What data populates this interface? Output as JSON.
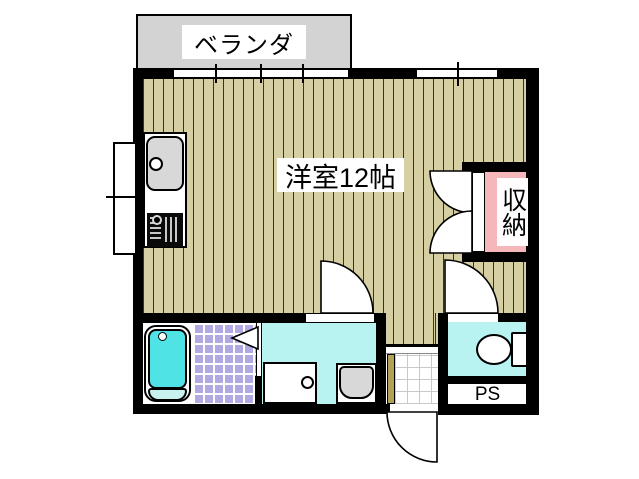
{
  "floorplan": {
    "labels": {
      "balcony": "ベランダ",
      "main_room": "洋室12帖",
      "storage": "収納",
      "pipe_space": "PS"
    },
    "colors": {
      "wall": "#000000",
      "flooring": "#d7cfa4",
      "balcony": "#d3d3d3",
      "storage_fill": "#f6b7bb",
      "wet_area_floor": "#b8f3f1",
      "bath_tile": "#b0a9e2",
      "bathtub": "#4fe3e6",
      "fixture_gray": "#d8d8d8"
    }
  }
}
